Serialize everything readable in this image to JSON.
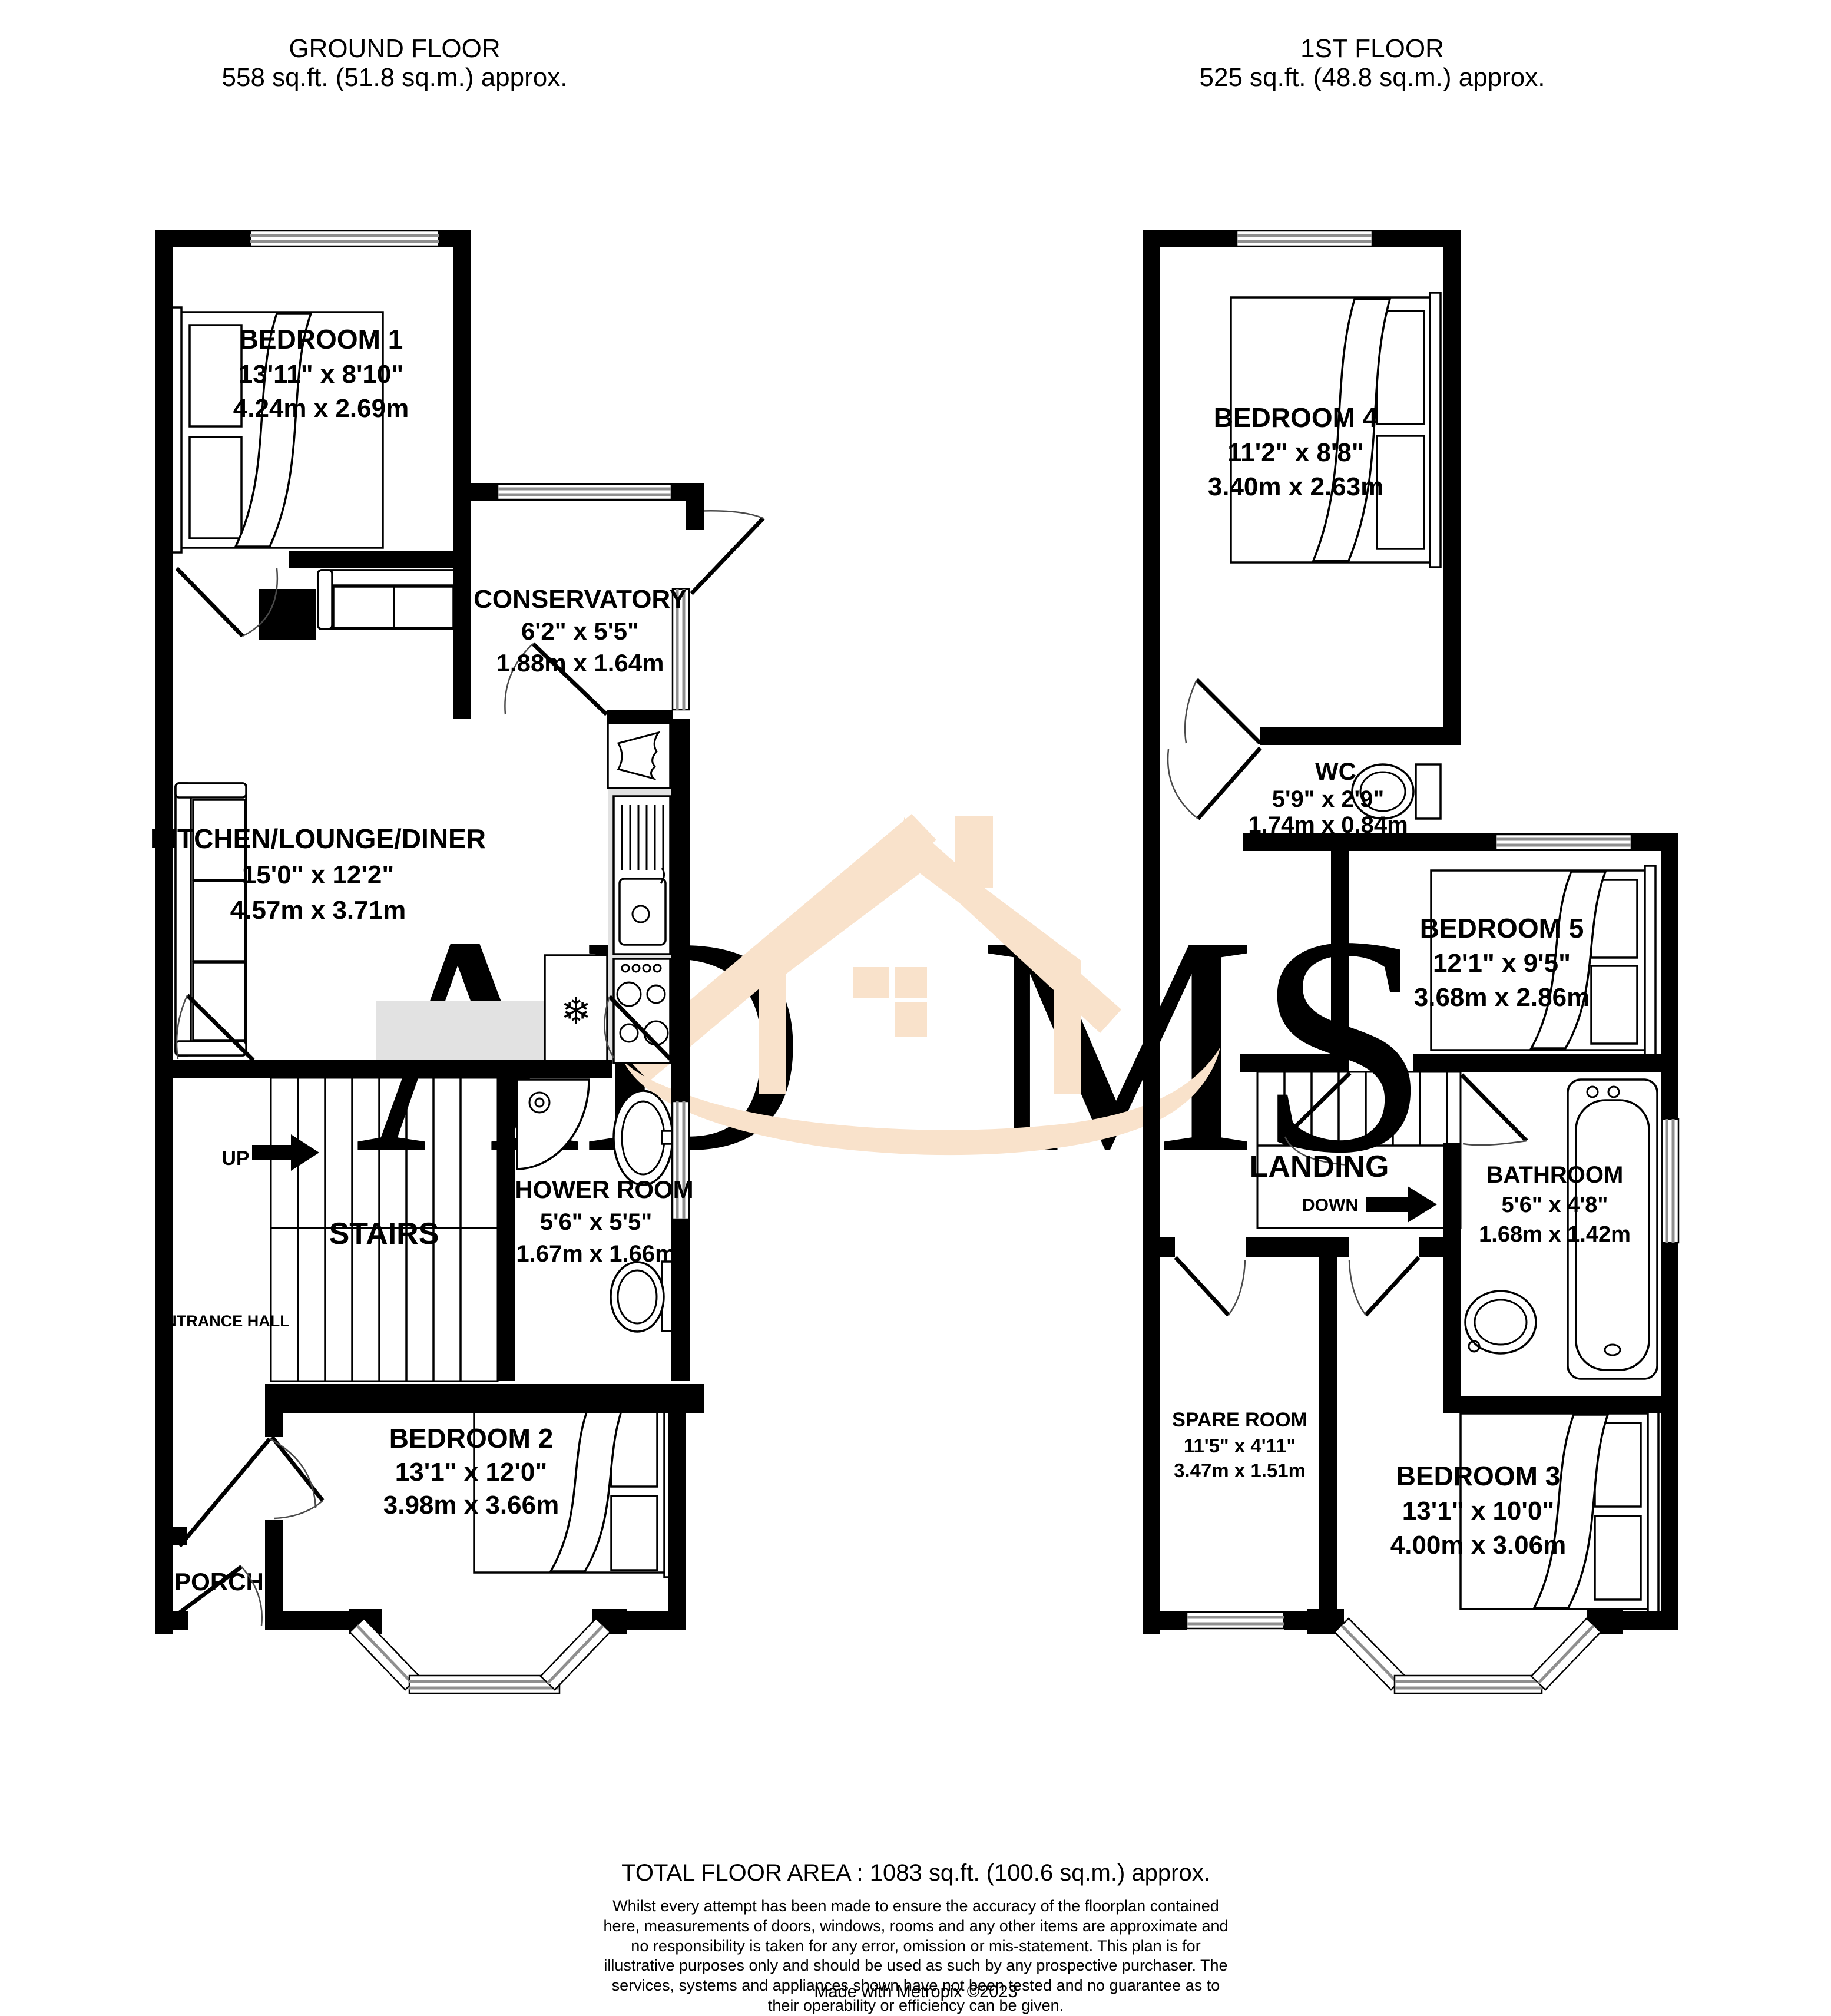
{
  "ground_floor": {
    "title": "GROUND FLOOR",
    "area": "558 sq.ft. (51.8 sq.m.) approx.",
    "rooms": {
      "bedroom1": {
        "name": "BEDROOM 1",
        "imperial": "13'11\"  x 8'10\"",
        "metric": "4.24m  x 2.69m"
      },
      "conservatory": {
        "name": "CONSERVATORY",
        "imperial": "6'2\"  x 5'5\"",
        "metric": "1.88m  x 1.64m"
      },
      "kitchen_lounge_diner": {
        "name": "KITCHEN/LOUNGE/DINER",
        "imperial": "15'0\"  x 12'2\"",
        "metric": "4.57m  x 3.71m"
      },
      "stairs": {
        "name": "STAIRS",
        "direction": "UP"
      },
      "shower_room": {
        "name": "SHOWER ROOM",
        "imperial": "5'6\"  x 5'5\"",
        "metric": "1.67m  x 1.66m"
      },
      "entrance_hall": {
        "name": "ENTRANCE HALL"
      },
      "bedroom2": {
        "name": "BEDROOM 2",
        "imperial": "13'1\"  x 12'0\"",
        "metric": "3.98m  x 3.66m"
      },
      "porch": {
        "name": "PORCH"
      }
    }
  },
  "first_floor": {
    "title": "1ST FLOOR",
    "area": "525 sq.ft. (48.8 sq.m.) approx.",
    "rooms": {
      "bedroom4": {
        "name": "BEDROOM 4",
        "imperial": "11'2\"  x 8'8\"",
        "metric": "3.40m  x 2.63m"
      },
      "wc": {
        "name": "WC",
        "imperial": "5'9\"  x 2'9\"",
        "metric": "1.74m  x 0.84m"
      },
      "bedroom5": {
        "name": "BEDROOM 5",
        "imperial": "12'1\"  x 9'5\"",
        "metric": "3.68m  x 2.86m"
      },
      "landing": {
        "name": "LANDING",
        "direction": "DOWN"
      },
      "bathroom": {
        "name": "BATHROOM",
        "imperial": "5'6\"  x 4'8\"",
        "metric": "1.68m  x 1.42m"
      },
      "spare_room": {
        "name": "SPARE ROOM",
        "imperial": "11'5\"  x 4'11\"",
        "metric": "3.47m  x 1.51m"
      },
      "bedroom3": {
        "name": "BEDROOM 3",
        "imperial": "13'1\"  x 10'0\"",
        "metric": "4.00m  x 3.06m"
      }
    }
  },
  "footer": {
    "total_area": "TOTAL FLOOR AREA : 1083 sq.ft. (100.6 sq.m.) approx.",
    "disclaimer": "Whilst every attempt has been made to ensure the accuracy of the floorplan contained here, measurements of doors, windows, rooms and any other items are approximate and no responsibility is taken for any error, omission or mis-statement. This plan is for illustrative purposes only and should be used as such by any prospective purchaser. The services, systems and appliances shown have not been tested and no guarantee as to their operability or efficiency can be given.",
    "credit": "Made with Metropix ©2023"
  },
  "watermark": {
    "left_text": "AD",
    "right_text": "MS",
    "letter_color": "#d9d9d9",
    "house_color": "#f9e2cb"
  }
}
